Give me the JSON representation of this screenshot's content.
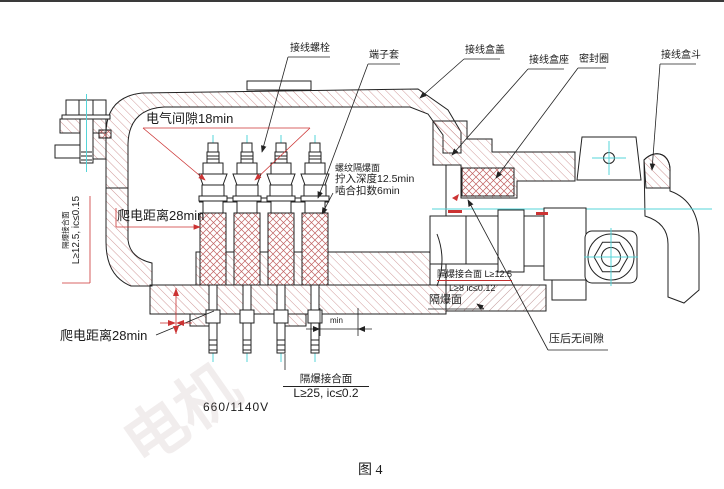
{
  "figure": {
    "caption": "图 4",
    "voltage": "660/1140V",
    "watermark": "电机"
  },
  "labels": {
    "terminal_bolt": "接线螺栓",
    "terminal_sleeve": "端子套",
    "box_cover": "接线盒盖",
    "box_seat": "接线盒座",
    "seal_ring": "密封圈",
    "box_hopper": "接线盒斗",
    "electrical_clearance": "电气间隙18min",
    "thread_flameproof_face": "螺纹隔爆面",
    "screw_in_depth": "拧入深度12.5min",
    "engaged_threads": "啮合扣数6min",
    "creepage_top": "爬电距离28min",
    "creepage_bottom": "爬电距离28min",
    "left_joint_title": "隔爆接合面",
    "left_joint_spec": "L≥12.5, ic≤0.15",
    "right_joint_spec1": "隔爆接合面 L≥12.5",
    "right_joint_spec2": "L≥8  ic≤0.12",
    "flameproof_face": "隔爆面",
    "no_gap_after_press": "压后无间隙",
    "bottom_joint_title": "隔爆接合面",
    "bottom_joint_spec": "L≥25, ic≤0.2",
    "min_dim": "min"
  },
  "colors": {
    "outline": "#222222",
    "hatch": "#c47f7f",
    "crosshatch": "#c06060",
    "centerline": "#55d4d8",
    "dimension": "#cc3333"
  }
}
